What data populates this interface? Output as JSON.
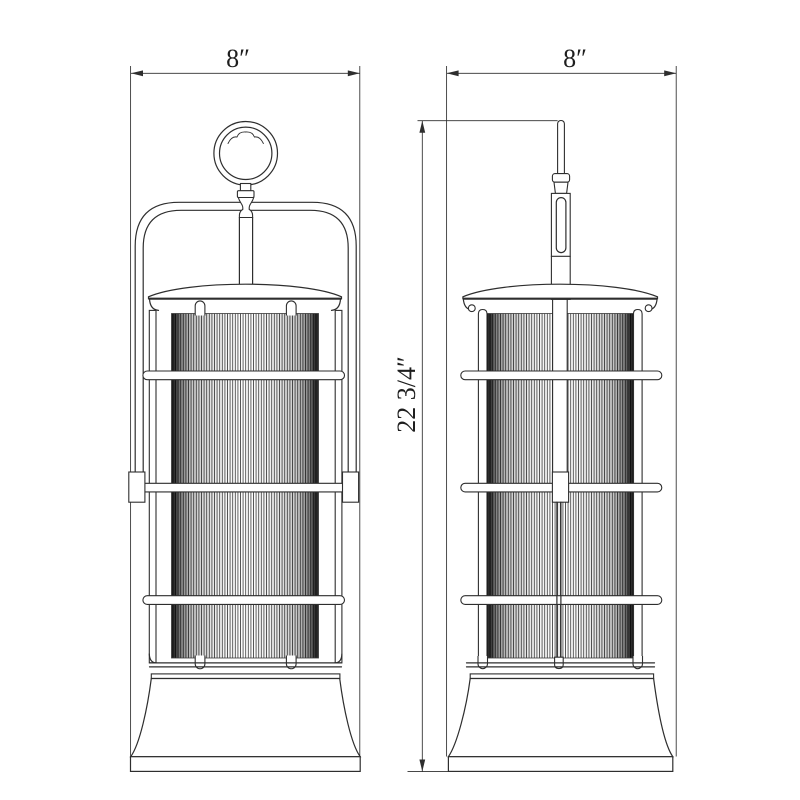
{
  "page": {
    "background": "#ffffff"
  },
  "drawing": {
    "subject": "hanging-lantern-dimension-drawing",
    "ink_color": "#2e2e2e",
    "glass_line_color": "#464646",
    "views": [
      {
        "id": "front-view",
        "name": "Front elevation",
        "width_label": "8″"
      },
      {
        "id": "side-view",
        "name": "Side elevation",
        "width_label": "8″"
      }
    ],
    "height_label": "22 3/4″"
  }
}
